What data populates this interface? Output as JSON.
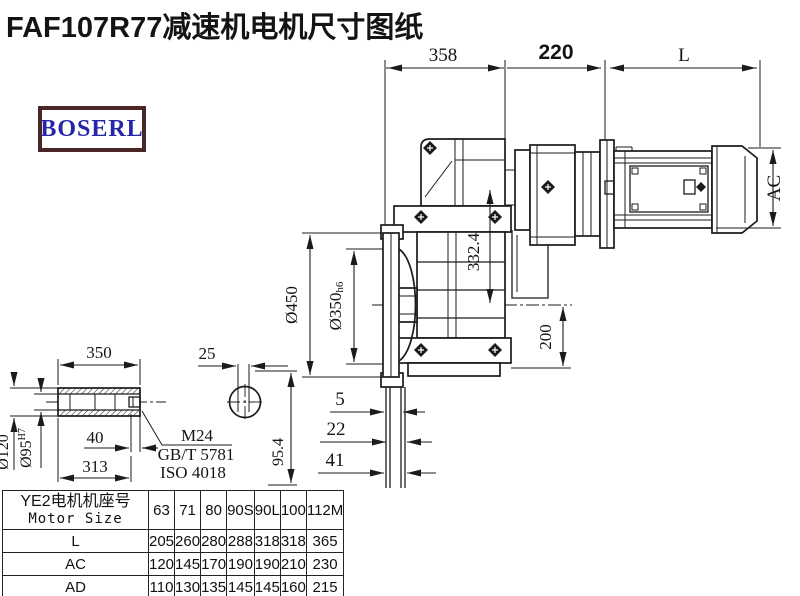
{
  "title": "FAF107R77减速机电机尺寸图纸",
  "logo": {
    "text": "BOSERL"
  },
  "colors": {
    "line": "#1b1b1b",
    "logo_border": "#4a2626",
    "logo_text": "#2626a8",
    "background": "#ffffff"
  },
  "dims": {
    "gearbox_width": "358",
    "adapter_width": "220",
    "motor_length": "L",
    "motor_height": "AC",
    "flange_od": "Ø450",
    "spigot_d": "Ø350",
    "spigot_tol": "h6",
    "center_distance": "332.4",
    "base_height": "200",
    "flange_t1": "5",
    "flange_t2": "22",
    "flange_t3": "41",
    "side_height": "95.4",
    "shaft_length": "350",
    "key_width": "25",
    "shaft_od": "Ø120",
    "bore_d": "Ø95",
    "bore_tol": "H7",
    "thread_depth": "40",
    "bore_length": "313",
    "thread": "M24",
    "standard1": "GB/T 5781",
    "standard2": "ISO 4018"
  },
  "table": {
    "header_cn": "YE2电机机座号",
    "header_en": "Motor Size",
    "sizes": [
      "63",
      "71",
      "80",
      "90S",
      "90L",
      "100",
      "112M"
    ],
    "rows": [
      {
        "label": "L",
        "values": [
          "205",
          "260",
          "280",
          "288",
          "318",
          "318",
          "365"
        ]
      },
      {
        "label": "AC",
        "values": [
          "120",
          "145",
          "170",
          "190",
          "190",
          "210",
          "230"
        ]
      },
      {
        "label": "AD",
        "values": [
          "110",
          "130",
          "135",
          "145",
          "145",
          "160",
          "215"
        ]
      }
    ]
  }
}
